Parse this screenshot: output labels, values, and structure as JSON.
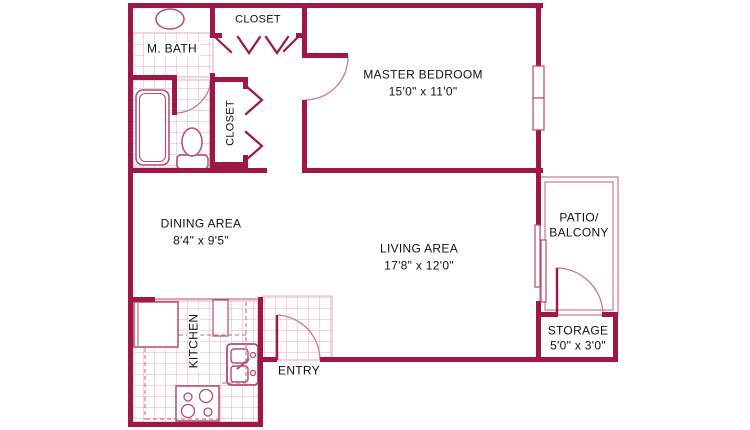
{
  "title": "Apartment Floor Plan",
  "colors": {
    "wall": "#9e1843",
    "fixture": "#b8496b",
    "arc": "#c9798f",
    "tile": "#e6aabb",
    "dashed": "#d07c93",
    "text": "#111111",
    "background": "#ffffff"
  },
  "rooms": {
    "master_bedroom": {
      "name": "MASTER BEDROOM",
      "dims": "15'0\" x 11'0\""
    },
    "m_bath": {
      "name": "M. BATH"
    },
    "closet_top": {
      "name": "CLOSET"
    },
    "closet_hall": {
      "name": "CLOSET"
    },
    "dining": {
      "name": "DINING AREA",
      "dims": "8'4\" x 9'5\""
    },
    "living": {
      "name": "LIVING AREA",
      "dims": "17'8\" x 12'0\""
    },
    "kitchen": {
      "name": "KITCHEN"
    },
    "entry": {
      "name": "ENTRY"
    },
    "patio": {
      "name_line1": "PATIO/",
      "name_line2": "BALCONY"
    },
    "storage": {
      "name": "STORAGE",
      "dims": "5'0\" x 3'0\""
    }
  }
}
